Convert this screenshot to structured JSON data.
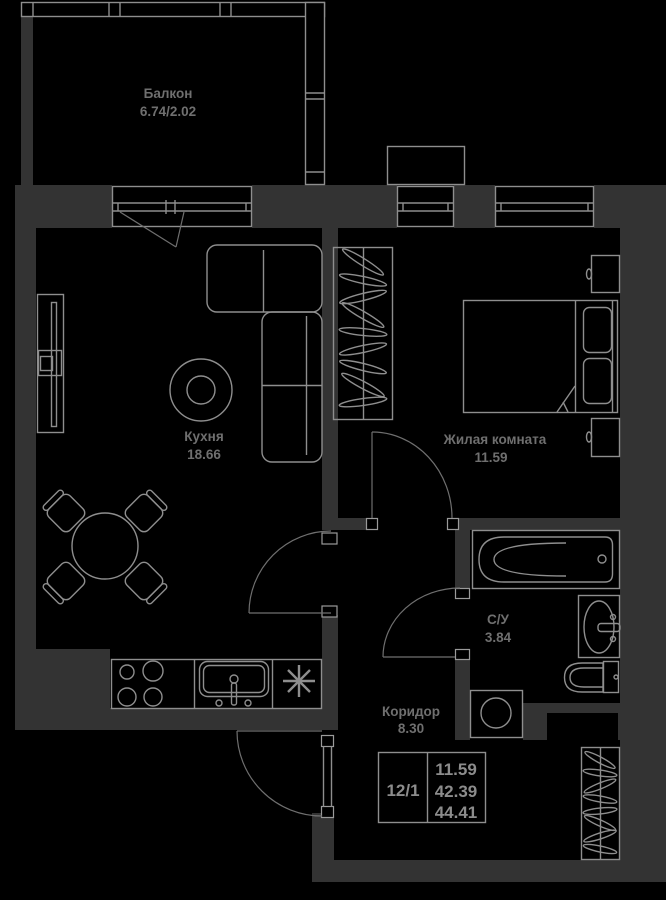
{
  "plan": {
    "title": "apartment-floor-plan",
    "rooms": [
      {
        "id": "balcony",
        "name": "Балкон",
        "area": "6.74/2.02"
      },
      {
        "id": "kitchen",
        "name": "Кухня",
        "area": "18.66"
      },
      {
        "id": "living",
        "name": "Жилая комната",
        "area": "11.59"
      },
      {
        "id": "bathroom",
        "name": "С/У",
        "area": "3.84"
      },
      {
        "id": "corridor",
        "name": "Коридор",
        "area": "8.30"
      }
    ],
    "stamp": {
      "unit": "12/1",
      "living_area": "11.59",
      "area_without_balcony": "42.39",
      "total_area": "44.41"
    },
    "colors": {
      "background": "#000000",
      "walls": "#333333",
      "lines": "#8e8e8e",
      "labels": "#6f6f6f",
      "stamp_text": "#8c8c8c"
    }
  }
}
